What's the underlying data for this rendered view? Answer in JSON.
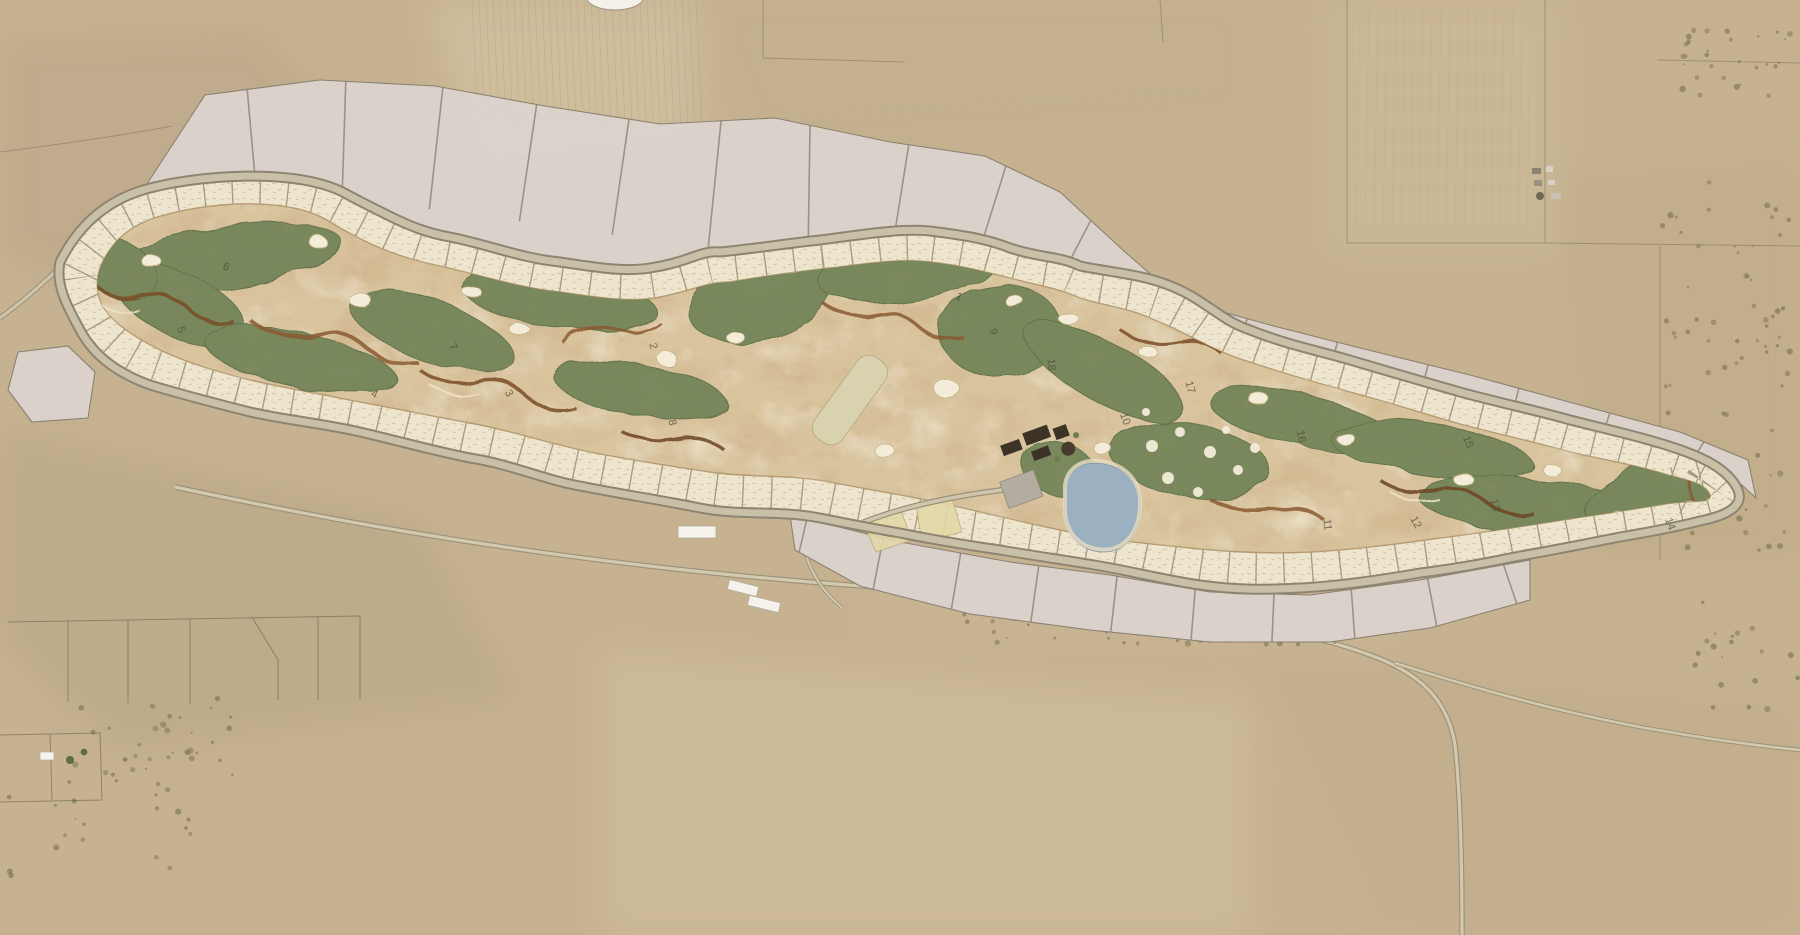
{
  "map": {
    "kind": "golf-course-community-master-plan-aerial",
    "terrain": "high-desert farmland",
    "features": {
      "golf_course": "18-hole course with green fairways over eroded sandy waste areas",
      "lot_band": "ring of small hatched residential lots around the course",
      "estate_parcels": "large light-gray perimeter estate parcels",
      "ring_road": "loop road between lot band and estate parcels",
      "pond": "irrigation pond beside clubhouse",
      "clubhouse": "clubhouse complex with parking and circular drive",
      "driving_range": "practice range strip west of clubhouse",
      "putting_course": "dotted short-game green east of pond",
      "maintenance_buildings": "white farm/maintenance buildings south of course",
      "rural_roads": "winding ranch roads along the wash to the south"
    },
    "holes": [
      {
        "n": "1",
        "x": 958,
        "y": 300,
        "r": 20
      },
      {
        "n": "2",
        "x": 650,
        "y": 347,
        "r": 75
      },
      {
        "n": "3",
        "x": 506,
        "y": 395,
        "r": 60
      },
      {
        "n": "4",
        "x": 373,
        "y": 397,
        "r": 25
      },
      {
        "n": "5",
        "x": 178,
        "y": 331,
        "r": 70
      },
      {
        "n": "6",
        "x": 225,
        "y": 270,
        "r": 20
      },
      {
        "n": "7",
        "x": 450,
        "y": 348,
        "r": 65
      },
      {
        "n": "8",
        "x": 669,
        "y": 423,
        "r": 80
      },
      {
        "n": "9",
        "x": 990,
        "y": 332,
        "r": 80
      },
      {
        "n": "10",
        "x": 1122,
        "y": 420,
        "r": 70
      },
      {
        "n": "11",
        "x": 1324,
        "y": 525,
        "r": 85
      },
      {
        "n": "12",
        "x": 1413,
        "y": 524,
        "r": 60
      },
      {
        "n": "13",
        "x": 1492,
        "y": 506,
        "r": 75
      },
      {
        "n": "14",
        "x": 1667,
        "y": 525,
        "r": 70
      },
      {
        "n": "15",
        "x": 1465,
        "y": 443,
        "r": 70
      },
      {
        "n": "16",
        "x": 1298,
        "y": 437,
        "r": 80
      },
      {
        "n": "17",
        "x": 1187,
        "y": 388,
        "r": 75
      },
      {
        "n": "18",
        "x": 1048,
        "y": 365,
        "r": 85
      }
    ],
    "palette": {
      "desert": "#c6b291",
      "desertLight": "#d3c2a2",
      "desertDark": "#b3a080",
      "parcelGray": "#dbd3ce",
      "parcelLine": "#87806f",
      "lotCream": "#ede5cd",
      "lotHatch": "#c8ba95",
      "lotTick": "#968b72",
      "roadFill": "#c9c0a8",
      "roadEdge": "#8d8571",
      "fairway": "#76875a",
      "fairwayEdge": "#5e7047",
      "sand": "#d9c49e",
      "sandLight": "#eadfc2",
      "erosionBrown": "#8a5a33",
      "erosionDark": "#6e4423",
      "bunker": "#f2ecd8",
      "pond": "#9bb1c1",
      "pondEdge": "#5d6f7e",
      "building": "#3c3226",
      "parking": "#b3aca1",
      "whiteBuilding": "#f4f2ea",
      "scrub": "#7f7852",
      "ink": "#4b4b3b",
      "goldLot": "#e3d8a8"
    }
  }
}
